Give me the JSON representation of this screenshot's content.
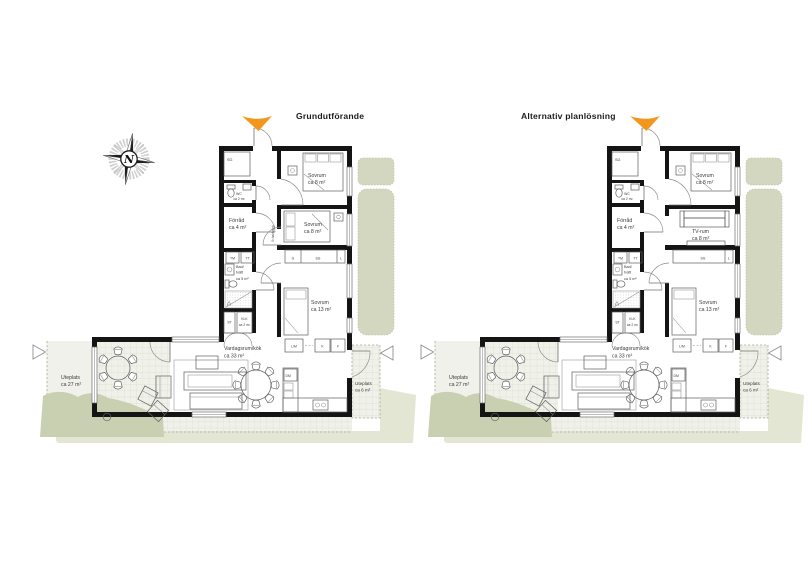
{
  "compass": {
    "label": "N"
  },
  "colors": {
    "wall": "#141414",
    "entrance_marker": "#F2971E",
    "hedge_green": "#d4d7c0",
    "lawn_green": "#c9cfb1",
    "pale_green": "#e3e6d3",
    "paving": "#f0f1ea"
  },
  "plans": [
    {
      "title": "Grundutförande",
      "rooms": {
        "hall_closet": "SG",
        "wc": {
          "name": "WC",
          "area": "ca 2 m²"
        },
        "bedroom_top": {
          "name": "Sovrum",
          "area": "ca 8 m²"
        },
        "storage": {
          "name": "Förråd",
          "area": "ca 4 m²"
        },
        "flex_room": {
          "name": "Sovrum",
          "area": "ca 8 m²"
        },
        "bath": {
          "line1": "Bad/",
          "line2": "tvätt",
          "area": "ca 5 m²"
        },
        "closet_st": "ST",
        "klk": {
          "name": "KLK",
          "area": "ca 2 m²"
        },
        "bedroom_large": {
          "name": "Sovrum",
          "area": "ca 13 m²"
        },
        "living": {
          "name": "Vardagsrum/kök",
          "area": "ca 33 m²"
        },
        "patio_small": {
          "name": "Uteplats",
          "area": "ca 6 m²"
        },
        "patio_large": {
          "name": "Uteplats",
          "area": "ca 27 m²"
        }
      },
      "appliances": {
        "tm": "TM",
        "tt": "TT",
        "g": "G",
        "sg": "SG",
        "l": "L",
        "lm": "L/M",
        "k": "K",
        "f": "F",
        "dm": "DM"
      },
      "wall_note": "Schaktvägg"
    },
    {
      "title": "Alternativ planlösning",
      "rooms": {
        "hall_closet": "SG",
        "wc": {
          "name": "WC",
          "area": "ca 2 m²"
        },
        "bedroom_top": {
          "name": "Sovrum",
          "area": "ca 8 m²"
        },
        "storage": {
          "name": "Förråd",
          "area": "ca 4 m²"
        },
        "flex_room": {
          "name": "TV-rum",
          "area": "ca 8 m²"
        },
        "bath": {
          "line1": "Bad/",
          "line2": "tvätt",
          "area": "ca 5 m²"
        },
        "closet_st": "ST",
        "klk": {
          "name": "KLK",
          "area": "ca 2 m²"
        },
        "bedroom_large": {
          "name": "Sovrum",
          "area": "ca 13 m²"
        },
        "living": {
          "name": "Vardagsrum/kök",
          "area": "ca 33 m²"
        },
        "patio_small": {
          "name": "Uteplats",
          "area": "ca 6 m²"
        },
        "patio_large": {
          "name": "Uteplats",
          "area": "ca 27 m²"
        }
      },
      "appliances": {
        "tm": "TM",
        "tt": "TT",
        "sg": "SG",
        "l": "L",
        "lm": "L/M",
        "k": "K",
        "f": "F",
        "dm": "DM"
      }
    }
  ]
}
